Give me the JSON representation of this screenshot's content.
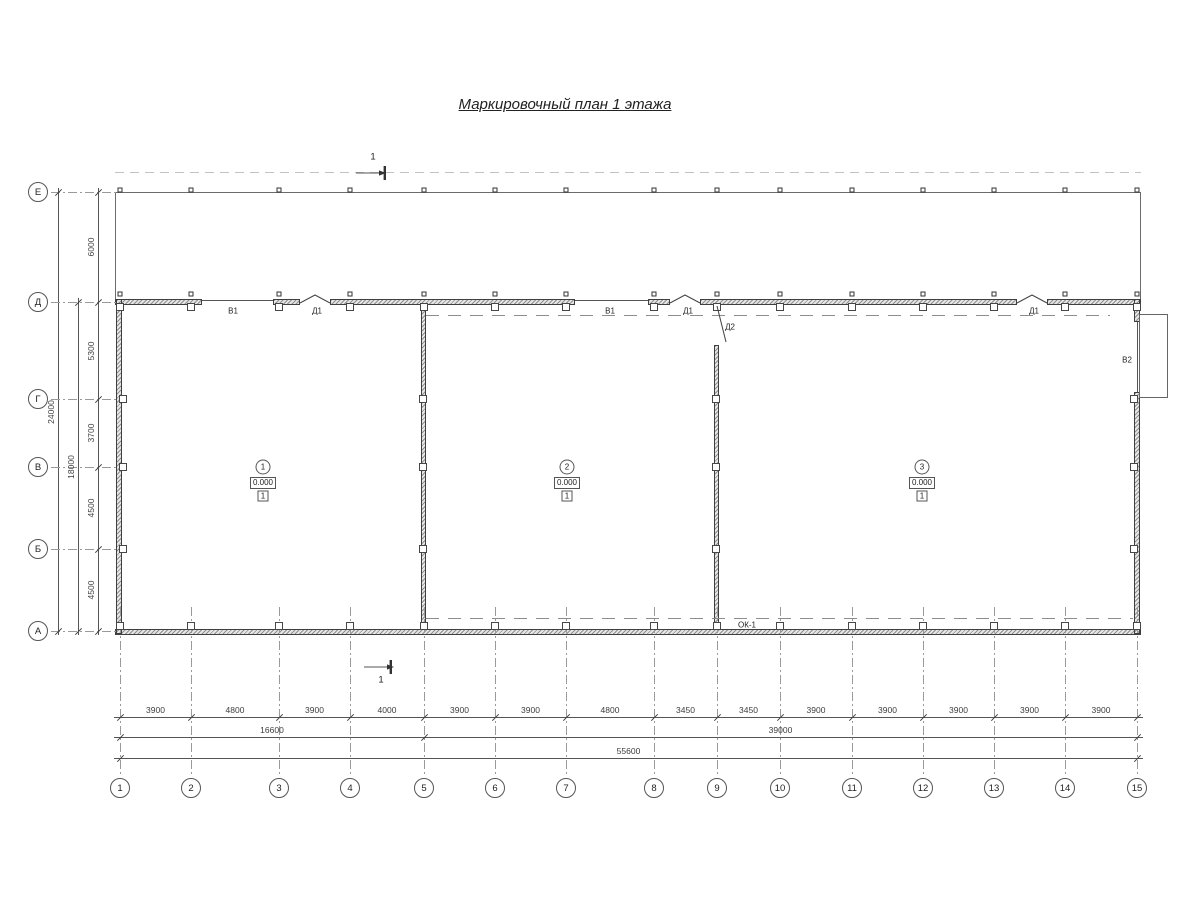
{
  "title": "Маркировочный план 1 этажа",
  "section_mark": {
    "label": "1"
  },
  "axes": {
    "rows": [
      {
        "label": "Е",
        "y": 192
      },
      {
        "label": "Д",
        "y": 302
      },
      {
        "label": "Г",
        "y": 399
      },
      {
        "label": "В",
        "y": 467
      },
      {
        "label": "Б",
        "y": 549
      },
      {
        "label": "А",
        "y": 631
      }
    ],
    "cols": [
      {
        "label": "1",
        "x": 120
      },
      {
        "label": "2",
        "x": 191
      },
      {
        "label": "3",
        "x": 279
      },
      {
        "label": "4",
        "x": 350
      },
      {
        "label": "5",
        "x": 424
      },
      {
        "label": "6",
        "x": 495
      },
      {
        "label": "7",
        "x": 566
      },
      {
        "label": "8",
        "x": 654
      },
      {
        "label": "9",
        "x": 717
      },
      {
        "label": "10",
        "x": 780
      },
      {
        "label": "11",
        "x": 852
      },
      {
        "label": "12",
        "x": 923
      },
      {
        "label": "13",
        "x": 994
      },
      {
        "label": "14",
        "x": 1065
      },
      {
        "label": "15",
        "x": 1137
      }
    ]
  },
  "dimensions": {
    "vertical_spans": [
      "6000",
      "5300",
      "3700",
      "4500",
      "4500"
    ],
    "vertical_subtotal": "18000",
    "vertical_total": "24000",
    "horizontal_spans": [
      "3900",
      "4800",
      "3900",
      "4000",
      "3900",
      "3900",
      "4800",
      "3450",
      "3450",
      "3900",
      "3900",
      "3900",
      "3900",
      "3900"
    ],
    "horizontal_subtotals": [
      {
        "value": "16600",
        "from": 0,
        "to": 4
      },
      {
        "value": "39000",
        "from": 4,
        "to": 14
      }
    ],
    "horizontal_total": "55600"
  },
  "rooms": [
    {
      "number": "1",
      "elevation": "0.000",
      "floor_type": "1",
      "x": 263,
      "y": 467
    },
    {
      "number": "2",
      "elevation": "0.000",
      "floor_type": "1",
      "x": 567,
      "y": 467
    },
    {
      "number": "3",
      "elevation": "0.000",
      "floor_type": "1",
      "x": 922,
      "y": 467
    }
  ],
  "opening_labels": [
    {
      "label": "В1",
      "x": 233,
      "y": 311
    },
    {
      "label": "Д1",
      "x": 317,
      "y": 311
    },
    {
      "label": "В1",
      "x": 610,
      "y": 311
    },
    {
      "label": "Д1",
      "x": 688,
      "y": 311
    },
    {
      "label": "Д2",
      "x": 730,
      "y": 327
    },
    {
      "label": "Д1",
      "x": 1034,
      "y": 311
    },
    {
      "label": "В2",
      "x": 1127,
      "y": 360
    },
    {
      "label": "ОК-1",
      "x": 747,
      "y": 625
    }
  ],
  "colors": {
    "line": "#4a4a4a",
    "dim": "#555555",
    "dash": "#9a9a9a",
    "wall_edge": "#3f3f3f"
  }
}
